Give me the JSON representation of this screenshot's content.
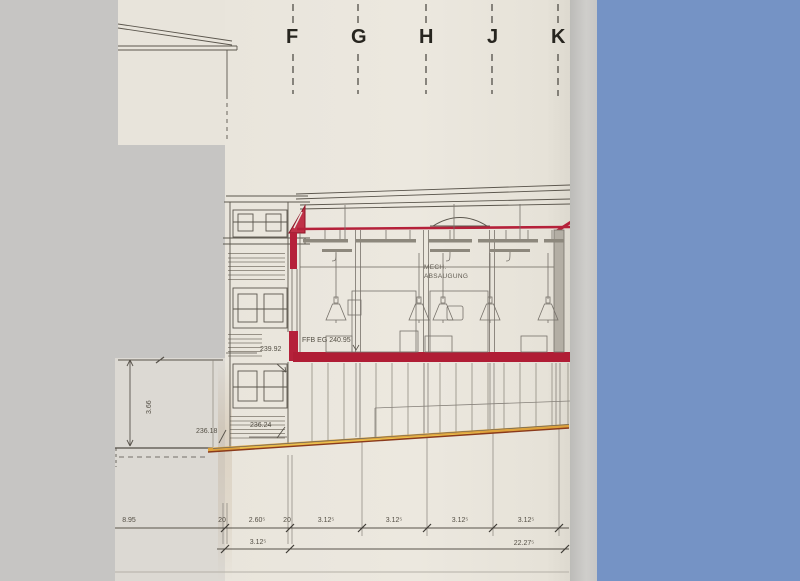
{
  "grid": {
    "labels": [
      "F",
      "G",
      "H",
      "J",
      "K"
    ]
  },
  "annotations": {
    "mech_line1": "MECH.",
    "mech_line2": "ABSAUGUNG",
    "ffb_level": "FFB EG 240.95",
    "level_upper": "239.92",
    "level_ground_left": "236.18",
    "level_ground_right": "236.24",
    "height_dim": "3.66"
  },
  "dimensions": {
    "row1": [
      "8.95",
      "20",
      "2.60⁵",
      "20",
      "3.12⁵",
      "3.12⁵",
      "3.12⁵",
      "3.12⁵"
    ],
    "row2": [
      "3.12⁵",
      "22.27⁵"
    ]
  },
  "colors": {
    "section_red": "#b5213a",
    "terrain_orange": "#dd9f35",
    "panel_blue": "#7593c5",
    "paper": "#eae6dd",
    "background": "#c6c5c3"
  }
}
